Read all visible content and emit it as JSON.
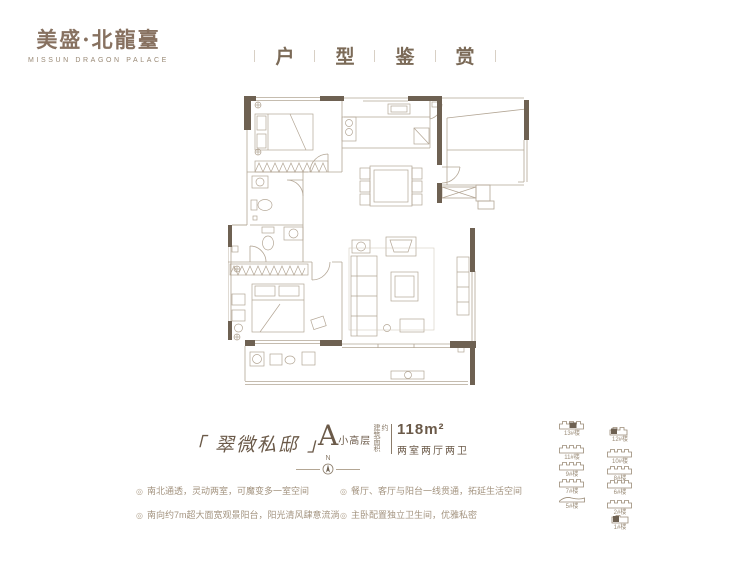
{
  "brand": {
    "name": "美盛·北龍臺",
    "subtitle": "MISSUN DRAGON PALACE"
  },
  "header": {
    "title_chars": [
      "户",
      "型",
      "鉴",
      "赏"
    ],
    "separator": "丨"
  },
  "unit": {
    "name_display": "「 翠微私邸 」",
    "type_letter": "A",
    "type_suffix": "小高层",
    "area_label_vertical": "建筑面积约",
    "area_value": "118m²",
    "layout": "两室两厅两卫"
  },
  "compass": {
    "label": "N"
  },
  "features": {
    "bullet": "◎",
    "left": [
      "南北通透，灵动两室，可魔变多一室空间",
      "南向约7m超大面宽观景阳台，阳光清风肆意流淌"
    ],
    "right": [
      "餐厅、客厅与阳台一线贯通，拓延生活空间",
      "主卧配置独立卫生间，优雅私密"
    ]
  },
  "siteplan": {
    "buildings_left": [
      "13#楼",
      "11#楼",
      "9#楼",
      "7#楼",
      "5#楼"
    ],
    "buildings_right": [
      "12#楼",
      "10#楼",
      "8#楼",
      "6#楼",
      "2#楼",
      "1#楼"
    ],
    "highlighted": [
      "13#楼",
      "1#楼"
    ]
  },
  "colors": {
    "brand": "#877160",
    "title": "#7b6a57",
    "wall": "#6e6152",
    "plan_line": "#b3a695",
    "text_dark": "#6b5a49",
    "text_light": "#a3937f"
  }
}
